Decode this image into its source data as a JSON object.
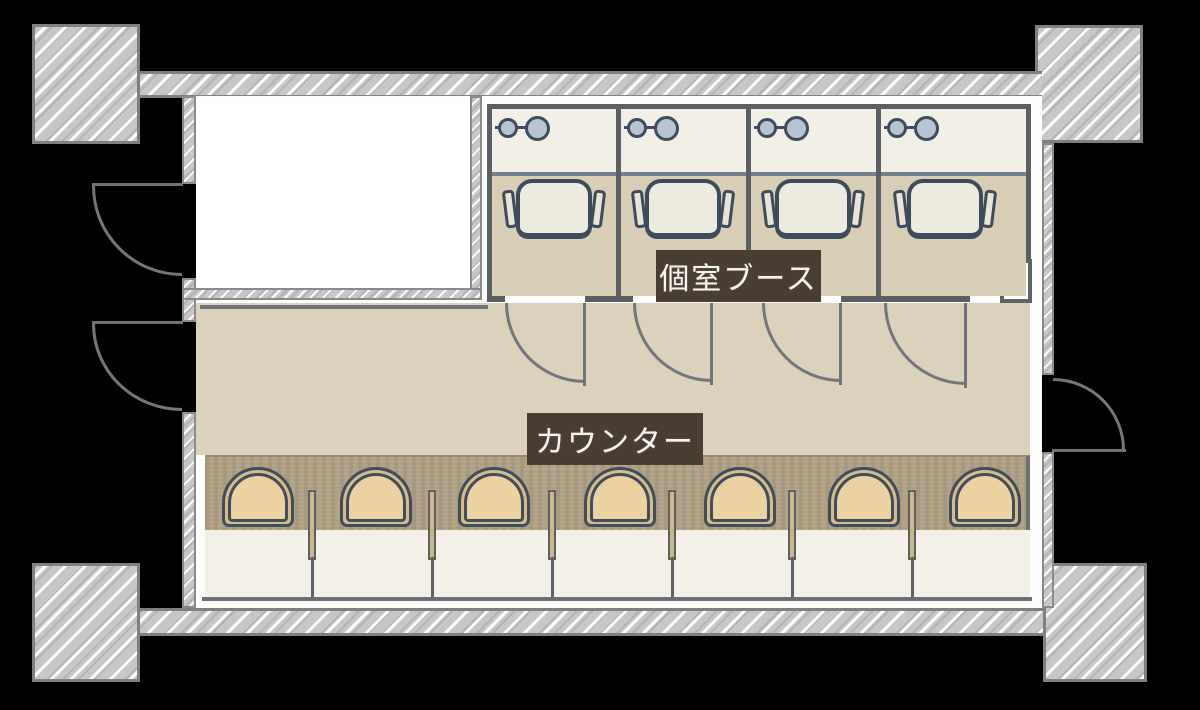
{
  "title": "floor-plan",
  "labels": {
    "booth_area": "個室ブース",
    "counter": "カウンター"
  },
  "palette": {
    "background": "#000000",
    "wall_hatch": "#c7c7c7",
    "wall_line": "#5a5f63",
    "corridor_floor": "#dcd2bb",
    "booth_floor": "#d8cdb5",
    "desk_surface": "#f2efe7",
    "counter_surface": "#f3f0e8",
    "counter_band": "#b0a084",
    "seat_fill": "#ecd2a0",
    "seat_trim": "#d9bc85",
    "outline_navy": "#3f4d5e",
    "label_bg": "#4a3e33",
    "label_text": "#f6f4ef",
    "fixture_circle": "#b7c4d2"
  },
  "plan": {
    "booths": {
      "count": 4,
      "lefts": [
        492,
        621,
        751,
        881
      ],
      "widths": [
        124,
        125,
        125,
        145
      ],
      "divider_xs": [
        487,
        616,
        746,
        876
      ],
      "desk_top": 109,
      "desk_height": 63,
      "deskline_y": 172,
      "floor_top": 176,
      "floor_bottom": 296,
      "chair_center_offset": 62,
      "circle_small_offset": 16,
      "circle_big_offset": 45,
      "bottom_wall_y": 296,
      "bottom_wall_segments": [
        [
          491,
          505
        ],
        [
          585,
          633
        ],
        [
          712,
          762
        ],
        [
          841,
          970
        ]
      ]
    },
    "booth_doors": [
      {
        "x": 505,
        "y": 303,
        "r": 80
      },
      {
        "x": 633,
        "y": 303,
        "r": 79
      },
      {
        "x": 762,
        "y": 303,
        "r": 79
      },
      {
        "x": 884,
        "y": 303,
        "r": 82
      }
    ],
    "left_doors": [
      {
        "leaf_y": 183,
        "arc_y": 186,
        "x": 92,
        "r": 90,
        "arc_h": 90
      },
      {
        "leaf_y": 321,
        "arc_y": 324,
        "x": 92,
        "r": 90,
        "arc_h": 87
      }
    ],
    "right_door": {
      "x": 1052,
      "y": 378,
      "r": 72,
      "leaf_y": 449
    },
    "counter": {
      "seat_count": 7,
      "seat_centers": [
        258,
        376,
        494,
        620,
        740,
        864,
        985
      ],
      "seat_width": 72,
      "seat_top": 467,
      "seat_height": 60,
      "post_centers": [
        312,
        432,
        552,
        672,
        792,
        912
      ],
      "post_top": 490,
      "post_height": 70,
      "stem_top": 557,
      "stem_bottom": 597
    }
  }
}
